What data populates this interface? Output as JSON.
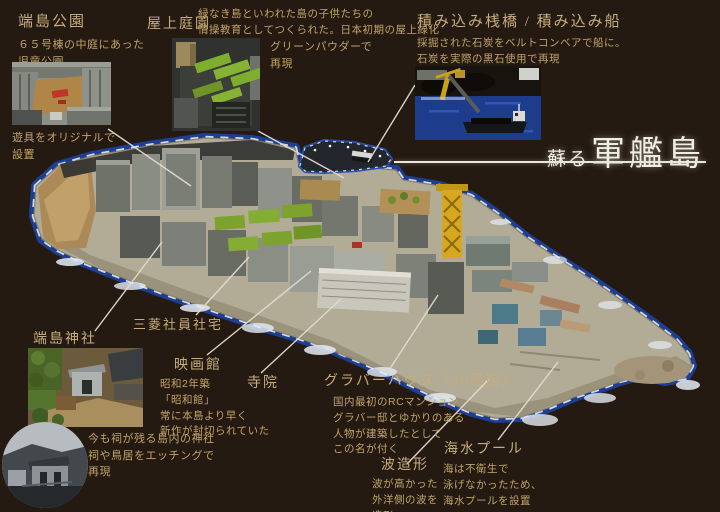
{
  "title": {
    "prefix": "蘇る",
    "main": "軍艦島"
  },
  "colors": {
    "background": "#241a12",
    "accent_text": "#c7ad7c",
    "body_text": "#c2a468",
    "title_text": "#f2ede2",
    "water_blue": "#1d3e92",
    "foam_white": "#e6ecf2"
  },
  "annotations": {
    "hashima_park": {
      "heading": "端島公園",
      "body": "６５号棟の中庭にあった\n児童公園",
      "caption": "遊具をオリジナルで\n設置"
    },
    "rooftop_garden": {
      "heading": "屋上庭園",
      "body": "緑なき島といわれた島の子供たちの\n情操教育としてつくられた。日本初期の屋上緑化",
      "caption": "グリーンパウダーで\n再現"
    },
    "loading_pier": {
      "heading": "積み込み桟橋 / 積み込み船",
      "body": "採掘された石炭をベルトコンベアで船に。\n石炭を実際の黒石使用で再現"
    },
    "hashima_shrine": {
      "heading": "端島神社",
      "caption": "今も祠が残る島内の神社\n祠や鳥居をエッチングで\n再現"
    },
    "mitsubishi_housing": {
      "heading": "三菱社員社宅"
    },
    "cinema": {
      "heading": "映画館",
      "body": "昭和2年築\n「昭和館」\n常に本島より早く\n新作が封切られていた"
    },
    "temple": {
      "heading": "寺院"
    },
    "glover_house": {
      "heading": "グラバーハウス（30号館）",
      "body": "国内最初のRCマンション\nグラバー邸とゆかりのある\n人物が建築したとして\nこの名が付く"
    },
    "wave_sculpting": {
      "heading": "波造形",
      "body": "波が高かった\n外洋側の波を\n造形"
    },
    "seawater_pool": {
      "heading": "海水プール",
      "body": "海は不衛生で\n泳げなかったため、\n海水プールを設置"
    }
  }
}
